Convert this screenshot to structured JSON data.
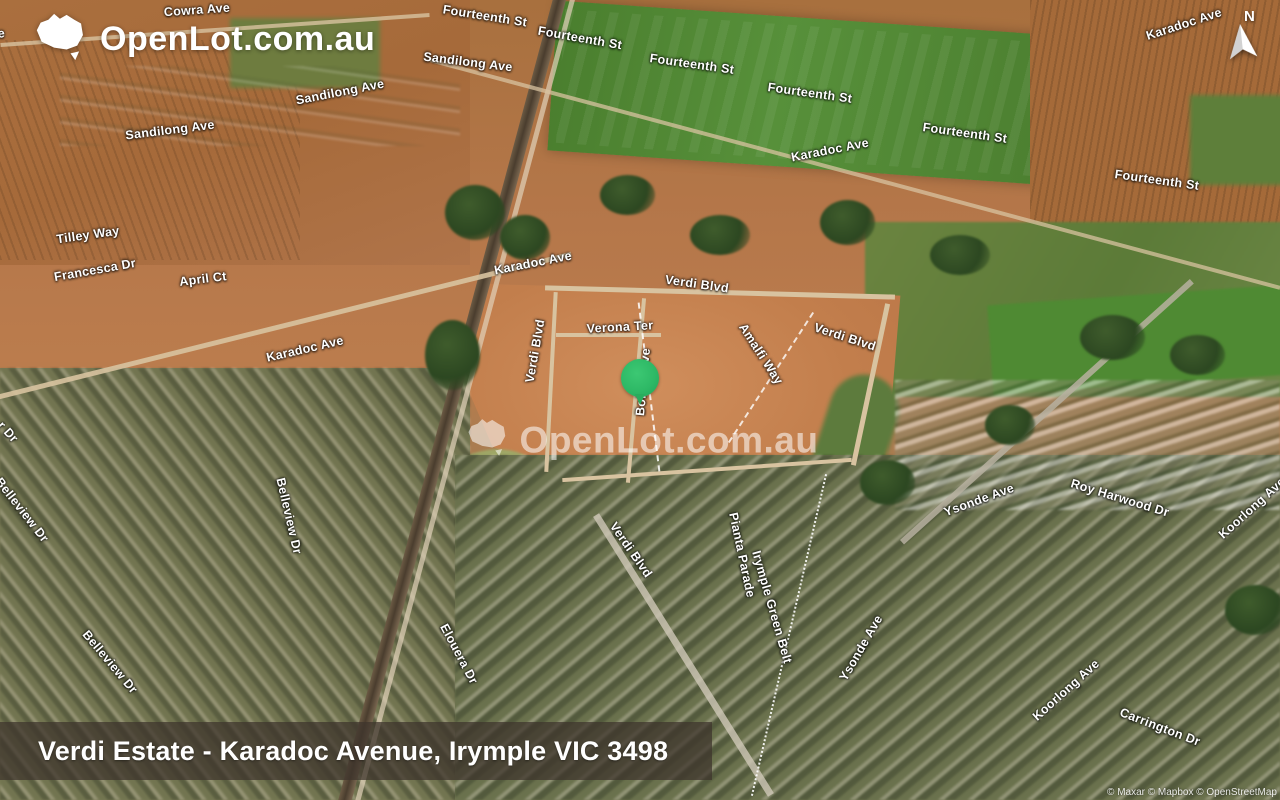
{
  "header": {
    "logo_text": "OpenLot.com.au",
    "logo_icon": "australia-map-icon"
  },
  "watermark": {
    "text": "OpenLot.com.au",
    "icon": "australia-map-icon"
  },
  "compass": {
    "label": "N"
  },
  "marker": {
    "color": "#2eb966",
    "x": 640,
    "y": 384
  },
  "banner": {
    "title": "Verdi Estate - Karadoc Avenue, Irymple VIC 3498"
  },
  "attribution": {
    "text": "© Maxar © Mapbox © OpenStreetMap"
  },
  "colors": {
    "marker_green": "#2eb966",
    "banner_bg": "rgba(62,52,45,0.74)",
    "label_text": "#ffffff"
  },
  "street_labels": [
    {
      "text": "Cowra Ave",
      "x": 197,
      "y": 10,
      "rot": -4
    },
    {
      "text": "Cowra Ave",
      "x": -28,
      "y": 36,
      "rot": -5
    },
    {
      "text": "Fourteenth St",
      "x": 485,
      "y": 16,
      "rot": 9
    },
    {
      "text": "Fourteenth St",
      "x": 580,
      "y": 38,
      "rot": 10
    },
    {
      "text": "Fourteenth St",
      "x": 692,
      "y": 64,
      "rot": 8
    },
    {
      "text": "Fourteenth St",
      "x": 810,
      "y": 93,
      "rot": 8
    },
    {
      "text": "Fourteenth St",
      "x": 965,
      "y": 133,
      "rot": 8
    },
    {
      "text": "Fourteenth St",
      "x": 1157,
      "y": 180,
      "rot": 8
    },
    {
      "text": "Sandilong Ave",
      "x": 468,
      "y": 62,
      "rot": 7
    },
    {
      "text": "Sandilong Ave",
      "x": 340,
      "y": 92,
      "rot": -11
    },
    {
      "text": "Sandilong Ave",
      "x": 170,
      "y": 130,
      "rot": -7
    },
    {
      "text": "Karadoc Ave",
      "x": 1184,
      "y": 24,
      "rot": -18
    },
    {
      "text": "Karadoc Ave",
      "x": 830,
      "y": 150,
      "rot": -11
    },
    {
      "text": "Karadoc Ave",
      "x": 533,
      "y": 263,
      "rot": -11
    },
    {
      "text": "Karadoc Ave",
      "x": 305,
      "y": 349,
      "rot": -13
    },
    {
      "text": "Tilley Way",
      "x": 88,
      "y": 235,
      "rot": -8
    },
    {
      "text": "Francesca Dr",
      "x": 95,
      "y": 270,
      "rot": -10
    },
    {
      "text": "April Ct",
      "x": 203,
      "y": 279,
      "rot": -7
    },
    {
      "text": "Verdi Blvd",
      "x": 697,
      "y": 284,
      "rot": 8
    },
    {
      "text": "Verdi Blvd",
      "x": 845,
      "y": 337,
      "rot": 18
    },
    {
      "text": "Verdi Blvd",
      "x": 535,
      "y": 351,
      "rot": -80
    },
    {
      "text": "Verona Ter",
      "x": 620,
      "y": 327,
      "rot": -3
    },
    {
      "text": "Amalfi Way",
      "x": 761,
      "y": 354,
      "rot": 57
    },
    {
      "text": "Bolton Ave",
      "x": 643,
      "y": 382,
      "rot": -85
    },
    {
      "text": "Verdi Blvd",
      "x": 631,
      "y": 550,
      "rot": 55
    },
    {
      "text": "Pianta Parade",
      "x": 742,
      "y": 555,
      "rot": 78
    },
    {
      "text": "Irymple Green Belt",
      "x": 772,
      "y": 607,
      "rot": 74
    },
    {
      "text": "Elouera Dr",
      "x": 459,
      "y": 654,
      "rot": 62
    },
    {
      "text": "Belleview Dr",
      "x": 22,
      "y": 510,
      "rot": 52
    },
    {
      "text": "Belleview Dr",
      "x": 289,
      "y": 516,
      "rot": 77
    },
    {
      "text": "Belleview Dr",
      "x": 110,
      "y": 662,
      "rot": 50
    },
    {
      "text": "Ysonde Ave",
      "x": 979,
      "y": 500,
      "rot": -20
    },
    {
      "text": "Roy Harwood Dr",
      "x": 1120,
      "y": 498,
      "rot": 17
    },
    {
      "text": "Koorlong Ave",
      "x": 1252,
      "y": 508,
      "rot": -42
    },
    {
      "text": "Ysonde Ave",
      "x": 861,
      "y": 648,
      "rot": -60
    },
    {
      "text": "Koorlong Ave",
      "x": 1066,
      "y": 690,
      "rot": -42
    },
    {
      "text": "Carrington Dr",
      "x": 1160,
      "y": 727,
      "rot": 21
    },
    {
      "text": "r Dr",
      "x": 8,
      "y": 432,
      "rot": 48
    }
  ]
}
